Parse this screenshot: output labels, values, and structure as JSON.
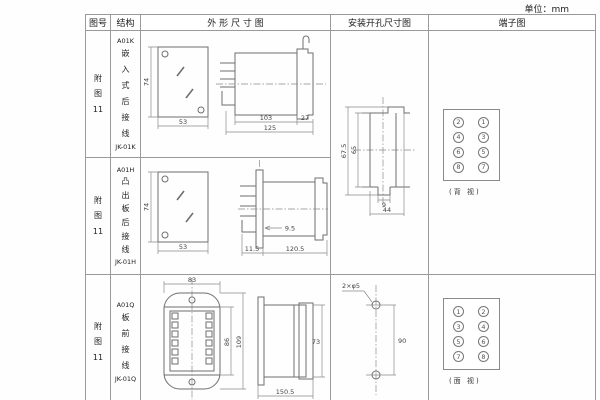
{
  "unit_label": "单位：mm",
  "table": {
    "headers": {
      "col_fig": "图号",
      "col_structure": "结构",
      "col_outline": "外 形 尺 寸 图",
      "col_install": "安装开孔尺寸图",
      "col_terminal": "端子图"
    }
  },
  "rows": [
    {
      "fig_lines": [
        "附",
        "图",
        "11"
      ],
      "structure_lines": [
        "A01K",
        "嵌",
        "入",
        "式",
        "后",
        "接",
        "线",
        "JK-01K"
      ],
      "outline": {
        "front_height": "74",
        "front_width": "53",
        "dim_body": "103",
        "dim_flange": "27",
        "dim_total": "125"
      }
    },
    {
      "fig_lines": [
        "附",
        "图",
        "11"
      ],
      "structure_lines": [
        "A01H",
        "凸",
        "出",
        "板",
        "后",
        "接",
        "线",
        "JK-01H"
      ],
      "outline": {
        "front_height": "74",
        "front_width": "53",
        "dim_a": "9.5",
        "dim_b": "11.5",
        "dim_total": "120.5"
      }
    },
    {
      "fig_lines": [
        "附",
        "图",
        "11"
      ],
      "structure_lines": [
        "A01Q",
        "板",
        "前",
        "接",
        "线",
        "JK-01Q"
      ],
      "outline": {
        "front_width": "83",
        "front_inner_height": "86",
        "front_total_height": "109",
        "side_height": "73",
        "side_length": "150.5"
      }
    }
  ],
  "install_kh": {
    "dim_outer": "67.5",
    "dim_inner": "65",
    "dim_slot": "9",
    "dim_width": "44"
  },
  "install_q": {
    "hole_label": "2×φ5",
    "dim_pitch": "90"
  },
  "terminal_rear": {
    "left": [
      "2",
      "4",
      "6",
      "8"
    ],
    "right": [
      "1",
      "3",
      "5",
      "7"
    ],
    "caption": "(背 视)"
  },
  "terminal_front": {
    "left": [
      "1",
      "3",
      "5",
      "7"
    ],
    "right": [
      "2",
      "4",
      "6",
      "8"
    ],
    "caption": "(面 视)"
  }
}
